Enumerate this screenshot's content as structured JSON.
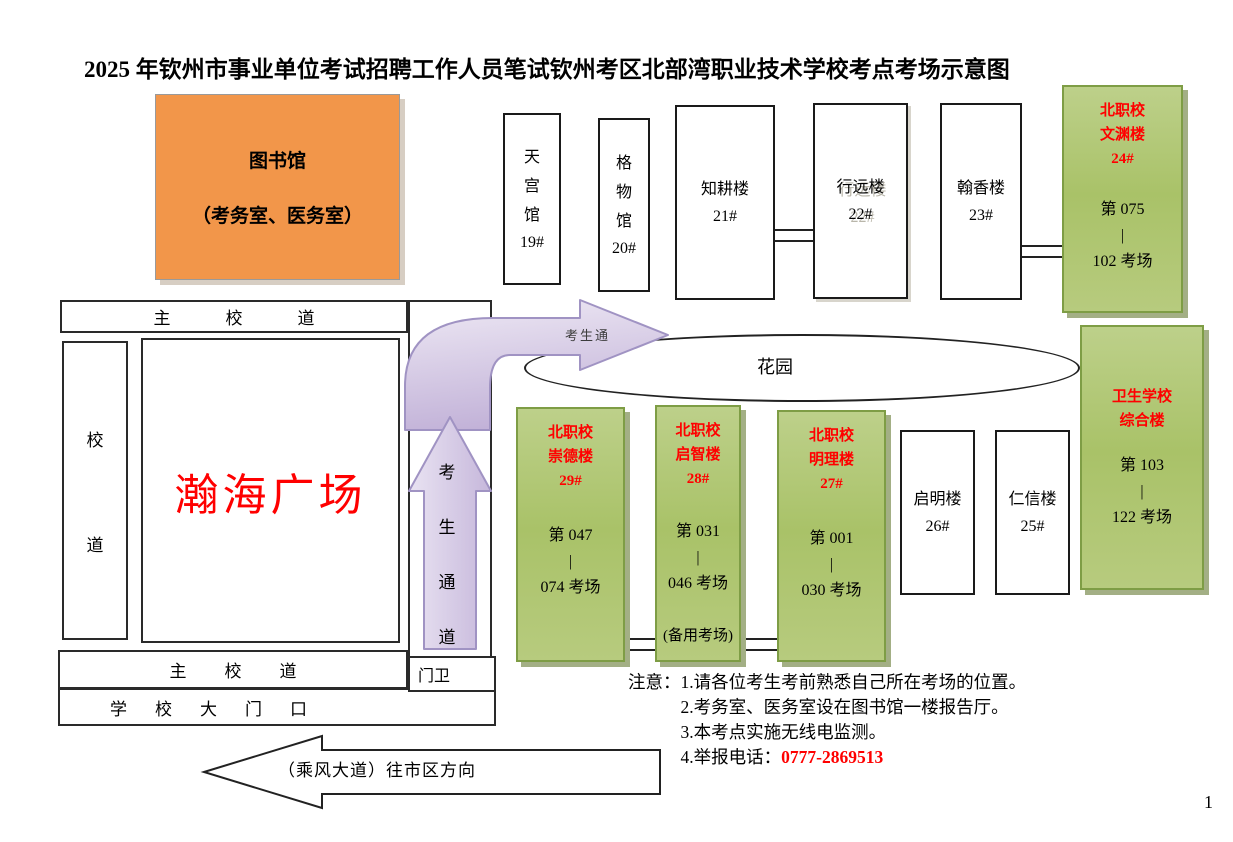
{
  "title": {
    "part1": "2025 年钦州市事业单位考试招聘工作人员笔试",
    "part2": "钦州考区北部湾职业技术学校考点考场示意图"
  },
  "library": {
    "name": "图书馆",
    "rooms": "（考务室、医务室）"
  },
  "roads": {
    "main_road_top": "主校道",
    "main_road_bottom": "主校道",
    "campus_road_chars": [
      "校",
      "道"
    ],
    "school_gate": "学校大门口",
    "guard_post": "门卫",
    "plaza": "瀚海广场",
    "street_direction": "（乘风大道）往市区方向",
    "candidate_path_chars": [
      "考",
      "生",
      "通",
      "道"
    ],
    "candidate_path_curve_label": "考生通"
  },
  "garden_label": "花园",
  "top_buildings": [
    {
      "name_chars": [
        "天",
        "宫",
        "馆"
      ],
      "number": "19#"
    },
    {
      "name_chars": [
        "格",
        "物",
        "馆"
      ],
      "number": "20#"
    },
    {
      "name": "知耕楼",
      "number": "21#"
    },
    {
      "name": "行远楼",
      "number": "22#"
    },
    {
      "name": "翰香楼",
      "number": "23#"
    }
  ],
  "side_buildings": [
    {
      "name": "启明楼",
      "number": "26#"
    },
    {
      "name": "仁信楼",
      "number": "25#"
    }
  ],
  "exam_buildings": [
    {
      "school": "北职校",
      "building": "文渊楼",
      "number": "24#",
      "rooms_from": "第 075",
      "rooms_sep": "|",
      "rooms_to": "102 考场"
    },
    {
      "school": "北职校",
      "building": "崇德楼",
      "number": "29#",
      "rooms_from": "第 047",
      "rooms_sep": "|",
      "rooms_to": "074 考场"
    },
    {
      "school": "北职校",
      "building": "启智楼",
      "number": "28#",
      "rooms_from": "第 031",
      "rooms_sep": "|",
      "rooms_to": "046 考场",
      "note": "(备用考场)"
    },
    {
      "school": "北职校",
      "building": "明理楼",
      "number": "27#",
      "rooms_from": "第 001",
      "rooms_sep": "|",
      "rooms_to": "030 考场"
    },
    {
      "school": "卫生学校",
      "building": "综合楼",
      "rooms_from": "第 103",
      "rooms_sep": "|",
      "rooms_to": "122 考场"
    }
  ],
  "notes": {
    "label": "注意：",
    "items": [
      "1.请各位考生考前熟悉自己所在考场的位置。",
      "2.考务室、医务室设在图书馆一楼报告厅。",
      "3.本考点实施无线电监测。",
      "4.举报电话："
    ],
    "phone": "0777-2869513"
  },
  "page_number": "1",
  "colors": {
    "library_orange": "#f2964a",
    "exam_building_green": "#aec56e",
    "exam_building_border": "#7e9d45",
    "highlight_red": "#ff0000",
    "path_purple": "#cdc0e0"
  }
}
